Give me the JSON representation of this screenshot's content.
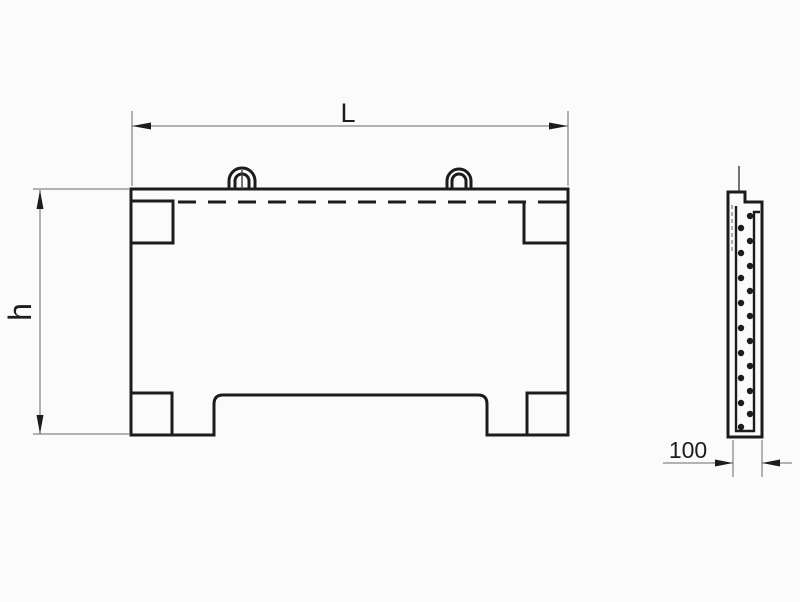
{
  "page": {
    "background": "#fbfbfb"
  },
  "drawing": {
    "kind": "technical-drawing-two-views",
    "front_view": {
      "dim_length_label": "L",
      "dim_height_label": "h"
    },
    "side_view": {
      "dim_thickness_label": "100"
    },
    "colors": {
      "main_line": "#1c1c1c",
      "dimension_line": "#6a6a6a",
      "background": "#fbfbfb"
    }
  }
}
